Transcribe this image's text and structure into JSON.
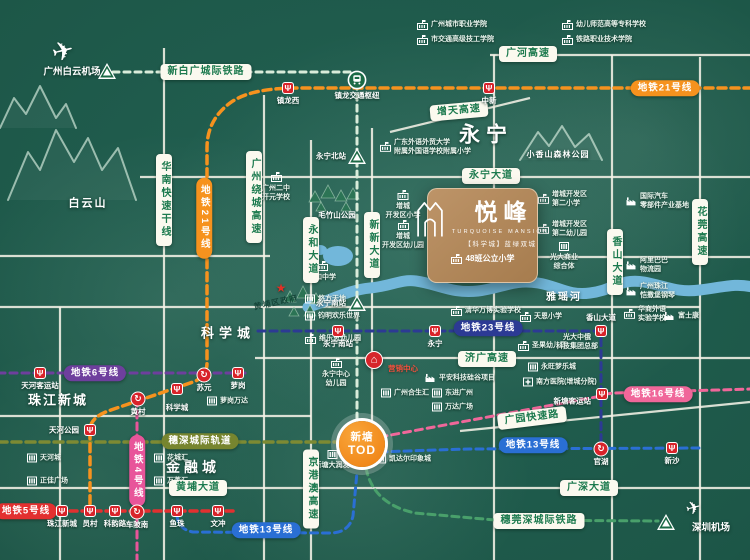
{
  "brand": {
    "name": "悦峰",
    "subtitle": "TURQUOISE MANSION",
    "tagline": "【科学城】蓝绿双城",
    "school": "48班公立小学"
  },
  "tod": {
    "line1": "新塘",
    "line2": "TOD"
  },
  "marker": {
    "label": "营销中心"
  },
  "colors": {
    "line21": "#f6921e",
    "line6": "#6e3f9d",
    "line5": "#e23030",
    "line4": "#e8559a",
    "line13": "#2a6fd4",
    "line16": "#f0679a",
    "line23": "#2c3a94",
    "intercity_xbg": "#d9ecda",
    "intercity_ss": "#7d8a33",
    "intercity_swd": "#49a06b",
    "road_pill_text": "#1c7a4e",
    "station_red": "#d8232a",
    "rail_green": "#1b6a45",
    "tod_orange": "#ee7e10"
  },
  "pills": [
    {
      "t": "广河高速",
      "x": 528,
      "y": 54
    },
    {
      "t": "新白广城际铁路",
      "x": 206,
      "y": 72
    },
    {
      "t": "增天高速",
      "x": 459,
      "y": 111,
      "rot": -5
    },
    {
      "t": "永宁大道",
      "x": 491,
      "y": 176
    },
    {
      "t": "华南快速干线",
      "x": 164,
      "y": 200,
      "v": 1
    },
    {
      "t": "地铁21号线",
      "x": 204,
      "y": 218,
      "v": 1,
      "c": "#f6921e"
    },
    {
      "t": "广州绕城高速",
      "x": 254,
      "y": 197,
      "v": 1
    },
    {
      "t": "永和大道",
      "x": 311,
      "y": 250,
      "v": 1
    },
    {
      "t": "新新大道",
      "x": 372,
      "y": 245,
      "v": 1
    },
    {
      "t": "香山大道",
      "x": 615,
      "y": 262,
      "v": 1
    },
    {
      "t": "花莞高速",
      "x": 700,
      "y": 232,
      "v": 1
    },
    {
      "t": "地铁21号线",
      "x": 665,
      "y": 88,
      "c": "#f6921e"
    },
    {
      "t": "地铁6号线",
      "x": 95,
      "y": 373,
      "c": "#6e3f9d"
    },
    {
      "t": "地铁23号线",
      "x": 488,
      "y": 328,
      "c": "#2c3a94"
    },
    {
      "t": "济广高速",
      "x": 487,
      "y": 359
    },
    {
      "t": "地铁16号线",
      "x": 658,
      "y": 394,
      "c": "#f0679a"
    },
    {
      "t": "广园快速路",
      "x": 532,
      "y": 418,
      "rot": -7
    },
    {
      "t": "穗深城际轨道",
      "x": 200,
      "y": 441,
      "c": "#77852f"
    },
    {
      "t": "地铁13号线",
      "x": 533,
      "y": 445,
      "c": "#2a6fd4"
    },
    {
      "t": "黄埔大道",
      "x": 198,
      "y": 488
    },
    {
      "t": "广深大道",
      "x": 589,
      "y": 488
    },
    {
      "t": "地铁4号线",
      "x": 137,
      "y": 471,
      "v": 1,
      "c": "#e8559a"
    },
    {
      "t": "地铁5号线",
      "x": 26,
      "y": 511,
      "c": "#e23030"
    },
    {
      "t": "京港澳高速",
      "x": 311,
      "y": 489,
      "v": 1
    },
    {
      "t": "穗莞深城际铁路",
      "x": 539,
      "y": 521
    },
    {
      "t": "地铁13号线",
      "x": 266,
      "y": 530,
      "c": "#2a6fd4"
    }
  ],
  "stations": [
    {
      "n": "中新",
      "x": 489,
      "y": 88,
      "t": "m",
      "lp": "b"
    },
    {
      "n": "镇龙西",
      "x": 288,
      "y": 88,
      "t": "m",
      "lp": "b"
    },
    {
      "n": "镇龙交通枢纽",
      "x": 357,
      "y": 80,
      "t": "h",
      "lp": "b",
      "dy": 3
    },
    {
      "n": "",
      "x": 107,
      "y": 71,
      "t": "r",
      "lp": "b"
    },
    {
      "n": "永宁北站",
      "x": 357,
      "y": 156,
      "t": "r",
      "lp": "l"
    },
    {
      "n": "永宁南站",
      "x": 357,
      "y": 303,
      "t": "r",
      "lp": "l"
    },
    {
      "n": "",
      "x": 666,
      "y": 522,
      "t": "r",
      "lp": "b"
    },
    {
      "n": "天河客运站",
      "x": 40,
      "y": 373,
      "t": "m",
      "lp": "b"
    },
    {
      "n": "苏元",
      "x": 204,
      "y": 375,
      "t": "x",
      "lp": "b"
    },
    {
      "n": "萝岗",
      "x": 238,
      "y": 373,
      "t": "m",
      "lp": "b"
    },
    {
      "n": "科学城",
      "x": 177,
      "y": 389,
      "t": "m",
      "lp": "b",
      "dy": 6
    },
    {
      "n": "黄村",
      "x": 138,
      "y": 399,
      "t": "x",
      "lp": "b"
    },
    {
      "n": "天河公园",
      "x": 90,
      "y": 430,
      "t": "m",
      "lp": "l"
    },
    {
      "n": "珠江新城",
      "x": 62,
      "y": 511,
      "t": "m",
      "lp": "b"
    },
    {
      "n": "员村",
      "x": 90,
      "y": 511,
      "t": "m",
      "lp": "b"
    },
    {
      "n": "科韵路",
      "x": 115,
      "y": 511,
      "t": "m",
      "lp": "b"
    },
    {
      "n": "车陂南",
      "x": 137,
      "y": 512,
      "t": "x",
      "lp": "b"
    },
    {
      "n": "鱼珠",
      "x": 177,
      "y": 511,
      "t": "m",
      "lp": "b"
    },
    {
      "n": "文冲",
      "x": 218,
      "y": 511,
      "t": "m",
      "lp": "b"
    },
    {
      "n": "永宁南站",
      "x": 338,
      "y": 331,
      "t": "m",
      "lp": "b"
    },
    {
      "n": "永宁",
      "x": 435,
      "y": 331,
      "t": "m",
      "lp": "b"
    },
    {
      "n": "香山大道",
      "x": 601,
      "y": 331,
      "t": "m",
      "lp": "a"
    },
    {
      "n": "新塘客运站",
      "x": 602,
      "y": 394,
      "t": "m",
      "lp": "l",
      "dy": 7
    },
    {
      "n": "官湖",
      "x": 601,
      "y": 449,
      "t": "x",
      "lp": "b"
    },
    {
      "n": "新沙",
      "x": 672,
      "y": 448,
      "t": "m",
      "lp": "b"
    }
  ],
  "landmarks": [
    {
      "x": 423,
      "y": 25,
      "ic": "school",
      "lay": "row",
      "ls": [
        "广州城市职业学院"
      ]
    },
    {
      "x": 423,
      "y": 40,
      "ic": "school",
      "lay": "row",
      "ls": [
        "市交通高级技工学院"
      ]
    },
    {
      "x": 568,
      "y": 25,
      "ic": "school",
      "lay": "row",
      "ls": [
        "幼儿师范高等专科学校"
      ]
    },
    {
      "x": 568,
      "y": 40,
      "ic": "school",
      "lay": "row",
      "ls": [
        "铁路职业技术学院"
      ]
    },
    {
      "x": 386,
      "y": 147,
      "ic": "school",
      "lay": "row",
      "ls": [
        "广东外语外贸大学",
        "附属外国语学校附属小学"
      ]
    },
    {
      "x": 276,
      "y": 178,
      "ic": "school",
      "lay": "col",
      "ls": [
        "广州二中",
        "开元学校"
      ]
    },
    {
      "x": 403,
      "y": 196,
      "ic": "school",
      "lay": "col",
      "ls": [
        "增城",
        "开发区小学"
      ]
    },
    {
      "x": 403,
      "y": 226,
      "ic": "school",
      "lay": "col",
      "ls": [
        "增城",
        "开发区幼儿园"
      ]
    },
    {
      "x": 544,
      "y": 199,
      "ic": "school",
      "lay": "row",
      "ls": [
        "增城开发区",
        "第二小学"
      ]
    },
    {
      "x": 544,
      "y": 229,
      "ic": "school",
      "lay": "row",
      "ls": [
        "增城开发区",
        "第二幼儿园"
      ]
    },
    {
      "x": 564,
      "y": 248,
      "ic": "building",
      "lay": "col",
      "ls": [
        "光大商业",
        "综合体"
      ]
    },
    {
      "x": 311,
      "y": 299,
      "ic": "building",
      "lay": "row",
      "ls": [
        "悠方天地"
      ]
    },
    {
      "x": 311,
      "y": 316,
      "ic": "building",
      "lay": "row",
      "ls": [
        "钧明欢乐世界"
      ]
    },
    {
      "x": 311,
      "y": 339,
      "ic": "school",
      "lay": "row",
      "ls": [
        "维乐思幼儿园"
      ]
    },
    {
      "x": 457,
      "y": 311,
      "ic": "school",
      "lay": "row",
      "ls": [
        "清华万博实验学校"
      ]
    },
    {
      "x": 526,
      "y": 317,
      "ic": "school",
      "lay": "row",
      "ls": [
        "天恩小学"
      ]
    },
    {
      "x": 524,
      "y": 346,
      "ic": "school",
      "lay": "row",
      "ls": [
        "圣果幼儿园"
      ]
    },
    {
      "x": 577,
      "y": 339,
      "ic": "none",
      "lay": "col",
      "ls": [
        "光大中俄",
        "科技集团总部"
      ]
    },
    {
      "x": 534,
      "y": 367,
      "ic": "building",
      "lay": "row",
      "ls": [
        "永旺梦乐城"
      ]
    },
    {
      "x": 529,
      "y": 382,
      "ic": "hospital",
      "lay": "row",
      "ls": [
        "南方医院(增城分院)"
      ]
    },
    {
      "x": 632,
      "y": 201,
      "ic": "factory",
      "lay": "row",
      "ls": [
        "国际汽车",
        "零部件产业基地"
      ]
    },
    {
      "x": 632,
      "y": 265,
      "ic": "factory",
      "lay": "row",
      "ls": [
        "阿里巴巴",
        "物流园"
      ]
    },
    {
      "x": 632,
      "y": 291,
      "ic": "factory",
      "lay": "row",
      "ls": [
        "广州珠江",
        "恺撒堡钢琴"
      ]
    },
    {
      "x": 630,
      "y": 314,
      "ic": "school",
      "lay": "row",
      "ls": [
        "华商外语",
        "实验学校"
      ]
    },
    {
      "x": 670,
      "y": 316,
      "ic": "factory",
      "lay": "row",
      "ls": [
        "富士康"
      ]
    },
    {
      "x": 336,
      "y": 364,
      "ic": "school",
      "lay": "col",
      "ls": [
        "永宁中心",
        "幼儿园"
      ]
    },
    {
      "x": 387,
      "y": 393,
      "ic": "building",
      "lay": "row",
      "ls": [
        "广州合生汇"
      ]
    },
    {
      "x": 431,
      "y": 378,
      "ic": "factory",
      "lay": "row",
      "ls": [
        "平安科技硅谷项目"
      ]
    },
    {
      "x": 438,
      "y": 393,
      "ic": "building",
      "lay": "row",
      "ls": [
        "东进广州"
      ]
    },
    {
      "x": 438,
      "y": 407,
      "ic": "building",
      "lay": "row",
      "ls": [
        "万达广场"
      ]
    },
    {
      "x": 213,
      "y": 401,
      "ic": "building",
      "lay": "row",
      "ls": [
        "萝岗万达"
      ]
    },
    {
      "x": 382,
      "y": 459,
      "ic": "building",
      "lay": "row",
      "ls": [
        "凯达尔印象城"
      ]
    },
    {
      "x": 332,
      "y": 456,
      "ic": "building",
      "lay": "col",
      "ls": [
        "新塘大润发"
      ]
    },
    {
      "x": 33,
      "y": 458,
      "ic": "building",
      "lay": "row",
      "ls": [
        "天河城"
      ]
    },
    {
      "x": 160,
      "y": 458,
      "ic": "building",
      "lay": "row",
      "ls": [
        "花城汇"
      ]
    },
    {
      "x": 33,
      "y": 481,
      "ic": "building",
      "lay": "row",
      "ls": [
        "正佳广场"
      ]
    },
    {
      "x": 160,
      "y": 481,
      "ic": "building",
      "lay": "row",
      "ls": [
        "万菱汇"
      ]
    },
    {
      "x": 322,
      "y": 267,
      "ic": "school",
      "lay": "col",
      "ls": [
        "永和中学"
      ]
    }
  ],
  "labels": [
    {
      "t": "永宁",
      "x": 486,
      "y": 135,
      "fs": 21,
      "lsp": 6
    },
    {
      "t": "科学城",
      "x": 228,
      "y": 333,
      "fs": 13,
      "lsp": 5
    },
    {
      "t": "珠江新城",
      "x": 58,
      "y": 400,
      "fs": 13,
      "lsp": 2
    },
    {
      "t": "金融城",
      "x": 193,
      "y": 467,
      "fs": 14,
      "lsp": 4
    },
    {
      "t": "白云山",
      "x": 88,
      "y": 204,
      "fs": 11,
      "lsp": 2
    },
    {
      "t": "小香山森林公园",
      "x": 558,
      "y": 155,
      "fs": 8,
      "lsp": 1
    },
    {
      "t": "毛竹山公园",
      "x": 337,
      "y": 215,
      "fs": 7.5,
      "lsp": 0
    },
    {
      "t": "雅瑶河",
      "x": 564,
      "y": 298,
      "fs": 10,
      "lsp": 2
    },
    {
      "t": "黄埔区政府",
      "x": 276,
      "y": 303,
      "fs": 8,
      "lsp": 1,
      "rot": -12,
      "dim": 1
    },
    {
      "t": "广州白云机场",
      "x": 72,
      "y": 72,
      "fs": 9.5,
      "lsp": 0
    },
    {
      "t": "深圳机场",
      "x": 711,
      "y": 528,
      "fs": 9.5,
      "lsp": 0
    }
  ]
}
